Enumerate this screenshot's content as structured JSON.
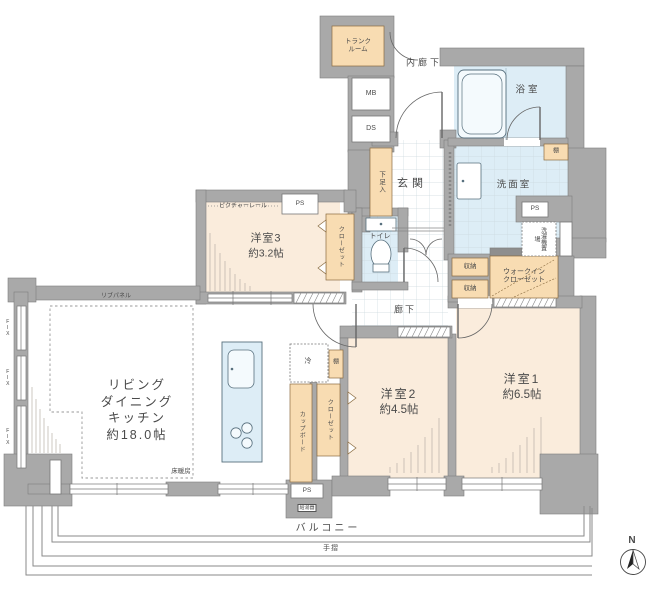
{
  "meta": {
    "type": "floor-plan",
    "area_unit": "帖"
  },
  "colors": {
    "wall": "#a9a9a9",
    "room_cream": "#faecdc",
    "fixture_orange": "#f8dcb2",
    "wet_blue": "#ddedf6"
  },
  "rooms": {
    "ldk": {
      "line1": "リビング",
      "line2": "ダイニング",
      "line3": "キッチン",
      "size": "約18.0帖",
      "floor_heating": "床暖房",
      "rib_panel": "リブパネル"
    },
    "bedroom3": {
      "name": "洋室3",
      "size": "約3.2帖",
      "picture_rail": "ピクチャーレール"
    },
    "bedroom2": {
      "name": "洋室2",
      "size": "約4.5帖"
    },
    "bedroom1": {
      "name": "洋室1",
      "size": "約6.5帖"
    },
    "entrance": "玄関",
    "hall": "廊下",
    "inner_corridor": "内廊下",
    "bathroom": "浴室",
    "washroom": "洗面室",
    "toilet": "トイレ",
    "trunk_room": {
      "line1": "トランク",
      "line2": "ルーム"
    },
    "walk_in_closet": {
      "line1": "ウォークイン",
      "line2": "クローゼット"
    },
    "balcony": "バルコニー"
  },
  "labels": {
    "ps": "PS",
    "mb": "MB",
    "ds": "DS",
    "shoe_cabinet": "下足入",
    "closet": "クローゼット",
    "cupboard": "カップボード",
    "shelf": "棚",
    "fridge": "冷",
    "storage": "収納",
    "washer_space": "洗濯機置場",
    "water_heater": "給湯器",
    "handrail": "手摺",
    "fix_window": "FIX",
    "compass_north": "N"
  }
}
